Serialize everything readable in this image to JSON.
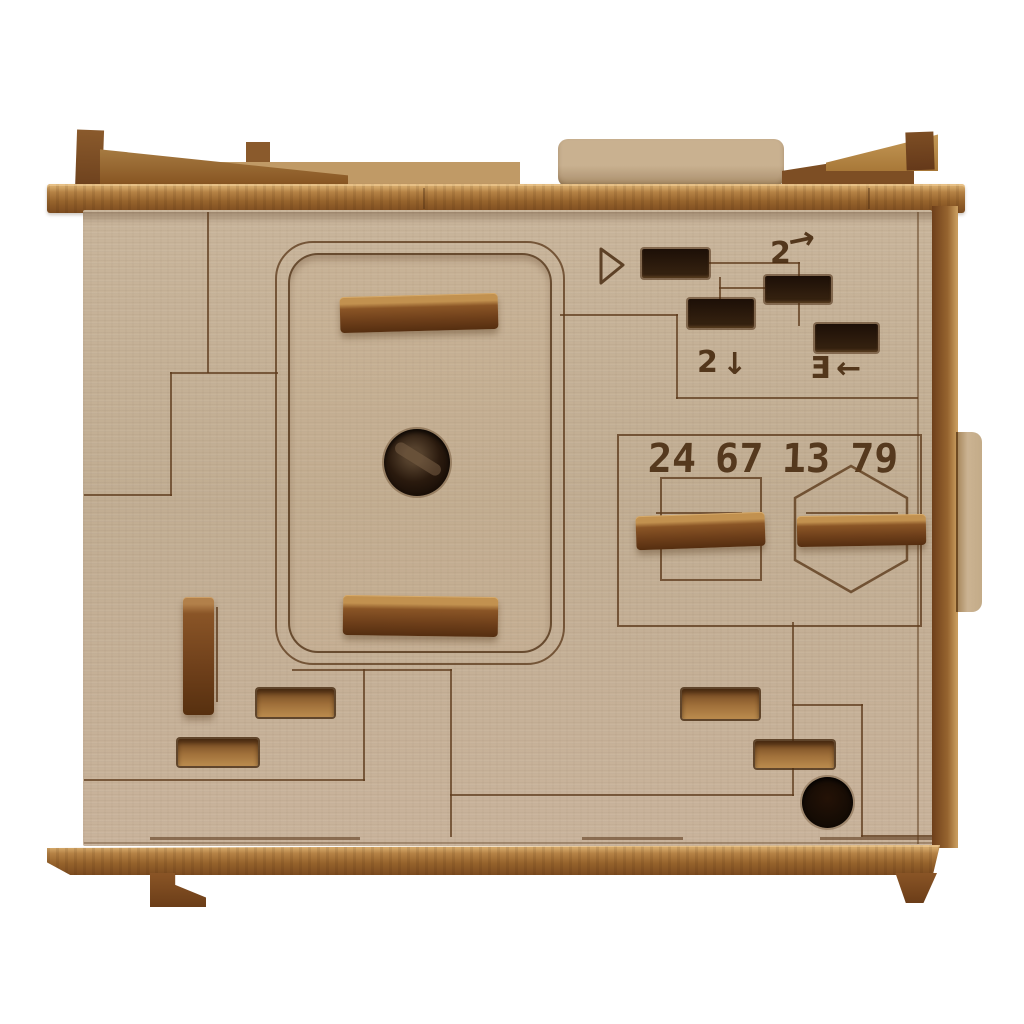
{
  "engravings": {
    "numbers": [
      "24",
      "67",
      "13",
      "79"
    ],
    "glyphs": {
      "two_right": {
        "digit": "2",
        "arrow": "→"
      },
      "two_down": {
        "digit": "2",
        "arrow": "↓"
      },
      "three_left": {
        "digit": "Ǝ",
        "arrow": "←"
      }
    }
  },
  "colors": {
    "background": "#ffffff",
    "face_wood": "#c5b197",
    "trim_wood": "#96632c",
    "handle_wood": "#6e3f1a",
    "engraving_brown": "#4a2d12",
    "slot_dark": "#241206"
  }
}
